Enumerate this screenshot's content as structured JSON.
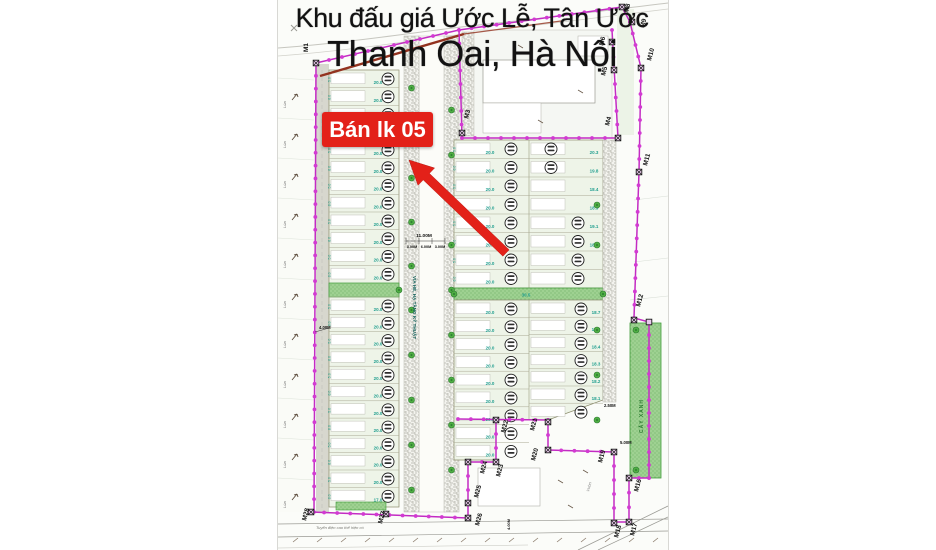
{
  "title": {
    "line1": "Khu đấu giá Ước Lễ, Tân Ước",
    "line2": "Thanh Oai, Hà Nội"
  },
  "sale_tag": {
    "text": "Bán lk 05"
  },
  "labels": {
    "sidewalk_text": "VỈA HÈ, HẠ TẦNG KỸ THUẬT",
    "green_strip": "CÂY XANH",
    "power_line": "Tuyến điện cao thế hiện có",
    "rice_field": "Lúa",
    "garden": "Vườn",
    "green_width": "30.5",
    "left_block_bottom": "17.0"
  },
  "dimensions": {
    "road_total": "11.00M",
    "road_parts": [
      "3.00M",
      "6.00M",
      "3.00M"
    ],
    "left_edge": "4.00M",
    "right_small": "2.50M",
    "right_offset": "5.00M",
    "bottom_road": "4.00M"
  },
  "plot_dims": {
    "left_width": "20.0",
    "colA_width": "20.0",
    "side_depths": [
      "5.0",
      "8.0"
    ],
    "colB_upper": [
      "20.3",
      "19.8",
      "18.4",
      "18.9",
      "19.1",
      "18.0",
      "",
      ""
    ],
    "colB_lower": [
      "18.7",
      "18.5",
      "18.4",
      "18.3",
      "18.2",
      "18.1",
      ""
    ]
  },
  "colors": {
    "boundary": "#c32bc3",
    "boundary_dot": "#d23ad2",
    "sale_red": "#e32119",
    "road_red": "#93321f",
    "dim_teal": "#1f9e8e",
    "green_fill": "#9ed191",
    "tree_green": "#4fae43",
    "plot_fill": "#eef4e8"
  },
  "markers": [
    {
      "id": "M1",
      "x": 38,
      "y": 63,
      "lx": 30,
      "ly": 52,
      "rot": -90
    },
    {
      "id": "M3",
      "x": 184,
      "y": 133,
      "lx": 190,
      "ly": 119,
      "rot": -75
    },
    {
      "id": "M4",
      "x": 340,
      "y": 138,
      "lx": 331,
      "ly": 126,
      "rot": -75
    },
    {
      "id": "M5",
      "x": 336,
      "y": 70,
      "lx": 327,
      "ly": 76,
      "rot": -75
    },
    {
      "id": "M6",
      "x": 334,
      "y": 42,
      "lx": 325,
      "ly": 46,
      "rot": -75
    },
    {
      "id": "M8",
      "x": 344,
      "y": 7,
      "lx": 350,
      "ly": 13,
      "rot": -75
    },
    {
      "id": "M9",
      "x": 354,
      "y": 22,
      "lx": 366,
      "ly": 28,
      "rot": -75
    },
    {
      "id": "M10",
      "x": 363,
      "y": 68,
      "lx": 373,
      "ly": 61,
      "rot": -75
    },
    {
      "id": "M11",
      "x": 361,
      "y": 172,
      "lx": 369,
      "ly": 166,
      "rot": -75
    },
    {
      "id": "M12",
      "x": 356,
      "y": 320,
      "lx": 362,
      "ly": 307,
      "rot": -75
    },
    {
      "id": "M16",
      "x": 351,
      "y": 478,
      "lx": 360,
      "ly": 492,
      "rot": -75
    },
    {
      "id": "M17",
      "x": 351,
      "y": 522,
      "lx": 356,
      "ly": 536,
      "rot": -75
    },
    {
      "id": "M18",
      "x": 336,
      "y": 523,
      "lx": 340,
      "ly": 538,
      "rot": -75
    },
    {
      "id": "M19",
      "x": 336,
      "y": 452,
      "lx": 324,
      "ly": 463,
      "rot": -75
    },
    {
      "id": "M20",
      "x": 270,
      "y": 450,
      "lx": 257,
      "ly": 461,
      "rot": -75
    },
    {
      "id": "M21",
      "x": 270,
      "y": 422,
      "lx": 256,
      "ly": 431,
      "rot": -75
    },
    {
      "id": "M22",
      "x": 218,
      "y": 420,
      "lx": 227,
      "ly": 433,
      "rot": -75
    },
    {
      "id": "M23",
      "x": 218,
      "y": 462,
      "lx": 222,
      "ly": 477,
      "rot": -75
    },
    {
      "id": "M24",
      "x": 190,
      "y": 462,
      "lx": 206,
      "ly": 474,
      "rot": -75
    },
    {
      "id": "M25",
      "x": 190,
      "y": 503,
      "lx": 200,
      "ly": 498,
      "rot": -75
    },
    {
      "id": "M26",
      "x": 190,
      "y": 518,
      "lx": 201,
      "ly": 526,
      "rot": -75
    },
    {
      "id": "M27",
      "x": 108,
      "y": 514,
      "lx": 104,
      "ly": 524,
      "rot": -75
    },
    {
      "id": "M28",
      "x": 33,
      "y": 512,
      "lx": 28,
      "ly": 521,
      "rot": -75
    }
  ],
  "rice_cells": 11
}
